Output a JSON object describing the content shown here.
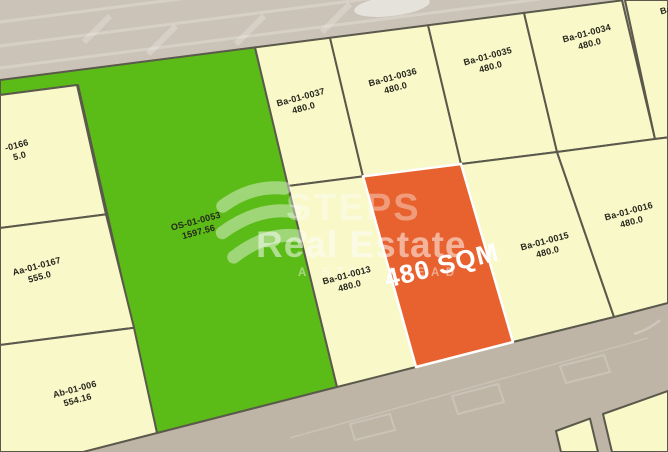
{
  "colors": {
    "road": "#cbc3b7",
    "road_bottom": "#bfb5a7",
    "plot_fill": "#f8f8c9",
    "plot_border": "#5a594b",
    "green_plot": "#5bbb17",
    "selected_plot": "#e8622f",
    "label_text": "#26261c",
    "watermark": "#ffffff"
  },
  "watermark": {
    "brand_top": "STEPS",
    "brand_bottom": "Real Estate",
    "tagline": "A STEP AHEAD"
  },
  "selected_plot": {
    "label": "480 SQM"
  },
  "plots": [
    {
      "id": "-0166",
      "area": "5.0"
    },
    {
      "id": "Aa-01-0167",
      "area": "555.0"
    },
    {
      "id": "Ab-01-006",
      "area": "554.16"
    },
    {
      "id": "OS-01-0053",
      "area": "1597.56"
    },
    {
      "id": "Ba-01-0037",
      "area": "480.0"
    },
    {
      "id": "Ba-01-0036",
      "area": "480.0"
    },
    {
      "id": "Ba-01-0035",
      "area": "480.0"
    },
    {
      "id": "Ba-01-0034",
      "area": "480.0"
    },
    {
      "id": "Ba",
      "area": ""
    },
    {
      "id": "Ba-01-0013",
      "area": "480.0"
    },
    {
      "id": "Ba-01-0015",
      "area": "480.0"
    },
    {
      "id": "Ba-01-0016",
      "area": "480.0"
    }
  ]
}
